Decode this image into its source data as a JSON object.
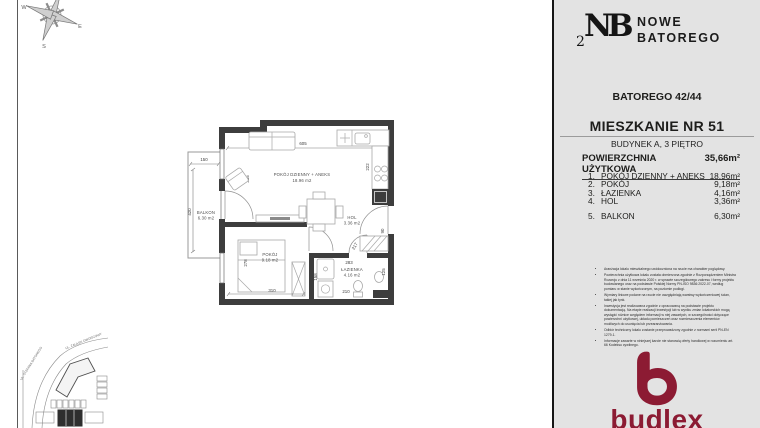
{
  "colors": {
    "sidebar_bg": "#e3e3e3",
    "wall": "#3d3d3d",
    "brand_red": "#8c1b33"
  },
  "header": {
    "monogram_digit": "2",
    "monogram_letters": "NB",
    "brand_line1": "NOWE",
    "brand_line2": "BATOREGO"
  },
  "sidebar": {
    "address": "BATOREGO 42/44",
    "apartment_title": "MIESZKANIE NR 51",
    "apartment_subtitle": "BUDYNEK A, 3 PIĘTRO",
    "area_label": "POWIERZCHNIA UŻYTKOWA",
    "area_value": "35,66m²",
    "rooms": [
      {
        "no": "1.",
        "name": "POKÓJ DZIENNY + ANEKS",
        "area": "18,96m²"
      },
      {
        "no": "2.",
        "name": "POKÓJ",
        "area": "9,18m²"
      },
      {
        "no": "3.",
        "name": "ŁAZIENKA",
        "area": "4,16m²"
      },
      {
        "no": "4.",
        "name": "HOL",
        "area": "3,36m²"
      },
      {
        "no": "5.",
        "name": "BALKON",
        "area": "6,30m²"
      }
    ],
    "disclaimers": [
      "Aranżacja lokalu mieszkalnego uwidoczniona na rzucie ma charakter poglądowy.",
      "Powierzchnia użytkowa lokalu została obmierzona zgodnie z Rozporządzeniem Ministra Rozwoju z dnia 11 września 2020 r. w sprawie szczegółowego zakresu i formy projektu budowlanego oraz na podstawie Polskiej Normy PN-ISO 9836:2022-07, według pomiaru w stanie wykończonym, na poziomie podłogi.",
      "Wymiary liniowe podane na rzucie nie uwzględniają warstwy wykończeniowej ścian, takiej jak tynk.",
      "Inwestycja jest realizowana zgodnie z opracowaną na podstawie projektu dokumentacją. Na etapie realizacji inwestycji lub w wyniku zmian lokatorskich mogą wystąpić różnice względem informacji w niej zawartych, w szczególności dotyczące powierzchni użytkowej, układu pomieszczeń oraz rozmieszczenia elementów możliwych do usunięcia lub przearanżowania.",
      "Odbiór techniczny lokalu zostanie przeprowadzony zgodnie z normami serii PN-EN 1279-1.",
      "Informacje zawarte w niniejszej karcie nie stanowią oferty handlowej w rozumieniu art. 66 Kodeksu cywilnego."
    ],
    "brand_wordmark": "budlex"
  },
  "floor_plan": {
    "living_name": "POKÓJ DZIENNY + ANEKS",
    "living_area": "18.96 m2",
    "hol_name": "HOL",
    "hol_area": "3.36 m2",
    "room_name": "POKÓJ",
    "room_area": "9.18 m2",
    "bath_name": "ŁAZIENKA",
    "bath_area": "4.16 m2",
    "balcony_name": "BALKON",
    "balcony_area": "6.30 m2",
    "dims": {
      "living_width": "605",
      "kitchen_side": "222",
      "living_left": "335",
      "balcony_width": "150",
      "balcony_height": "420",
      "room_height": "278",
      "room_width": "310",
      "bath_left": "158",
      "bath_top": "283",
      "bath_width": "210",
      "hol_width": "217",
      "bath_right": "125",
      "entry_side": "90"
    }
  },
  "compass": {
    "west": "W",
    "south": "S",
    "east": "E"
  },
  "site_plan": {
    "street_top": "UL. ZAUŁEK DWORCOWY",
    "street_left": "UL. STEFANA BATOREGO"
  }
}
